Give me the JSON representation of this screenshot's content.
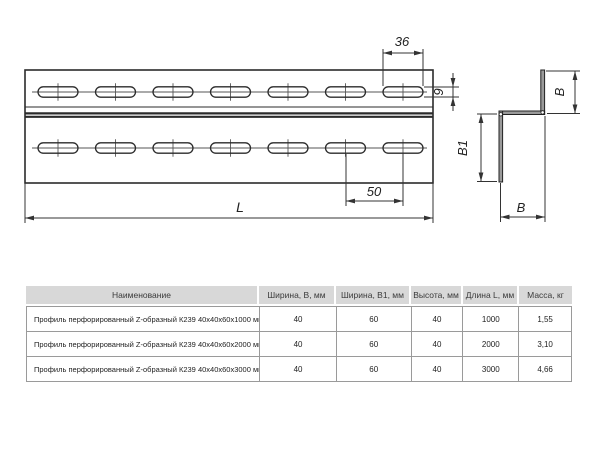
{
  "drawing": {
    "labels": {
      "slot_length": "36",
      "slot_height": "9",
      "slot_pitch": "50",
      "length": "L",
      "flange_top": "B",
      "web": "B1",
      "flange_bottom": "B"
    },
    "line_color": "#333333",
    "section_fill": "#9a9a9a"
  },
  "table": {
    "headers": [
      "Наименование",
      "Ширина, В, мм",
      "Ширина, В1, мм",
      "Высота, мм",
      "Длина L, мм",
      "Масса, кг"
    ],
    "rows": [
      {
        "name": "Профиль перфорированный Z-образный К239 40х40х60х1000 мм",
        "width_b": "40",
        "width_b1": "60",
        "height": "40",
        "length": "1000",
        "mass": "1,55"
      },
      {
        "name": "Профиль перфорированный Z-образный К239 40х40х60х2000 мм",
        "width_b": "40",
        "width_b1": "60",
        "height": "40",
        "length": "2000",
        "mass": "3,10"
      },
      {
        "name": "Профиль перфорированный Z-образный К239 40х40х60х3000 мм",
        "width_b": "40",
        "width_b1": "60",
        "height": "40",
        "length": "3000",
        "mass": "4,66"
      }
    ]
  }
}
